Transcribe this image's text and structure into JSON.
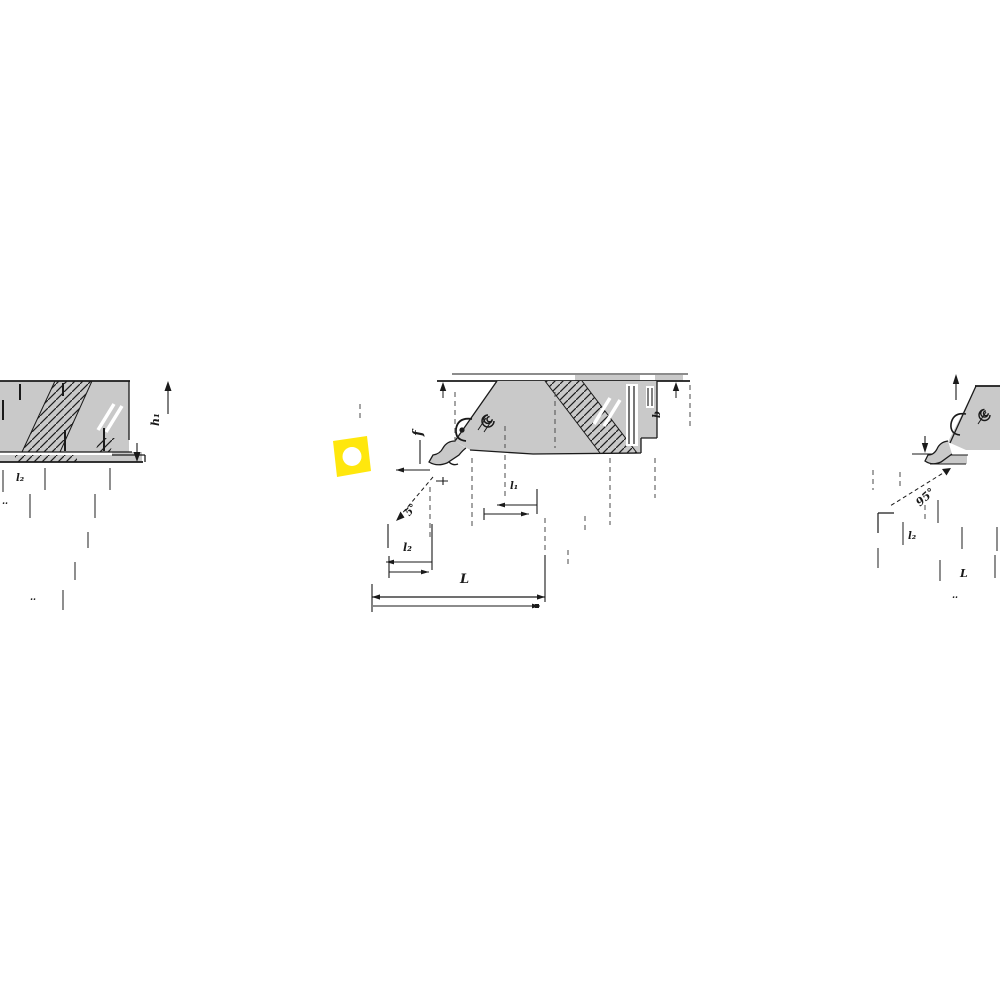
{
  "meta": {
    "description": "Technical dimension drawing strip of indexable turning tool holders with a yellow square insert icon"
  },
  "colors": {
    "background": "#ffffff",
    "tool_body_gray": "#c9c9c9",
    "line_black": "#1a1a1a",
    "insert_yellow": "#FFE70D",
    "insert_hole_white": "#ffffff"
  },
  "insert_icon": {
    "shape": "square-insert-with-center-hole"
  },
  "figures": {
    "left_view": {
      "dim_tip_height": "h₁",
      "dim_row1": "l₂",
      "marks_row2": "‥",
      "marks_lower": "‥"
    },
    "center_view": {
      "dim_offset": "f",
      "dim_edge": "l₁",
      "dim_angle": "5°",
      "dim_head_length": "l₂",
      "dim_overall_length": "L",
      "dim_width": "b"
    },
    "right_view": {
      "dim_angle": "95°",
      "dim_head_length": "l₂",
      "dim_overall_length": "L",
      "marks": "‥"
    }
  }
}
